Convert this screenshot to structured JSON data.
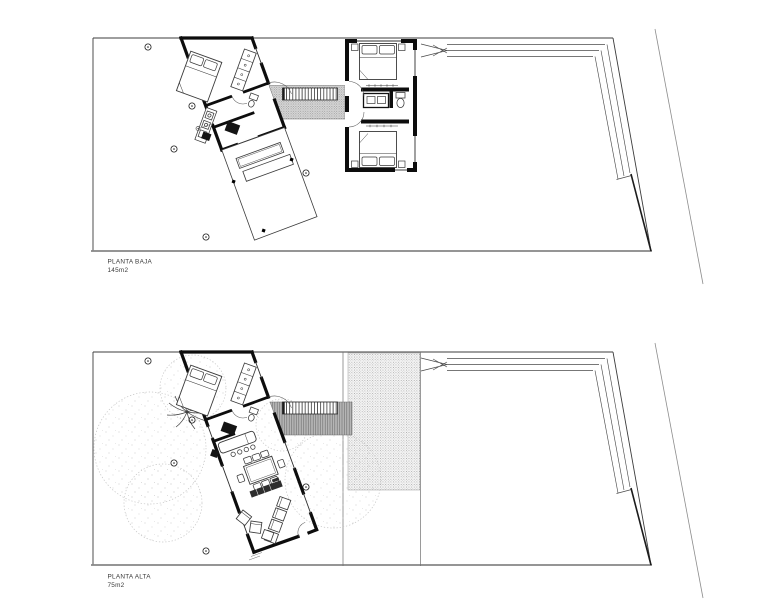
{
  "plans": [
    {
      "name": "planta-baja",
      "label": "PLANTA BAJA",
      "area": "145m2"
    },
    {
      "name": "planta-alta",
      "label": "PLANTA ALTA",
      "area": "75m2"
    }
  ],
  "colors": {
    "paper": "#ffffff",
    "ink": "#101010",
    "wall": "#0d0d0d",
    "grey_line": "#8a8a8a",
    "deck_fill": "#b8b8b8",
    "stipple_dot": "#8a8a8a",
    "canopy_line": "#c4c4c4"
  }
}
